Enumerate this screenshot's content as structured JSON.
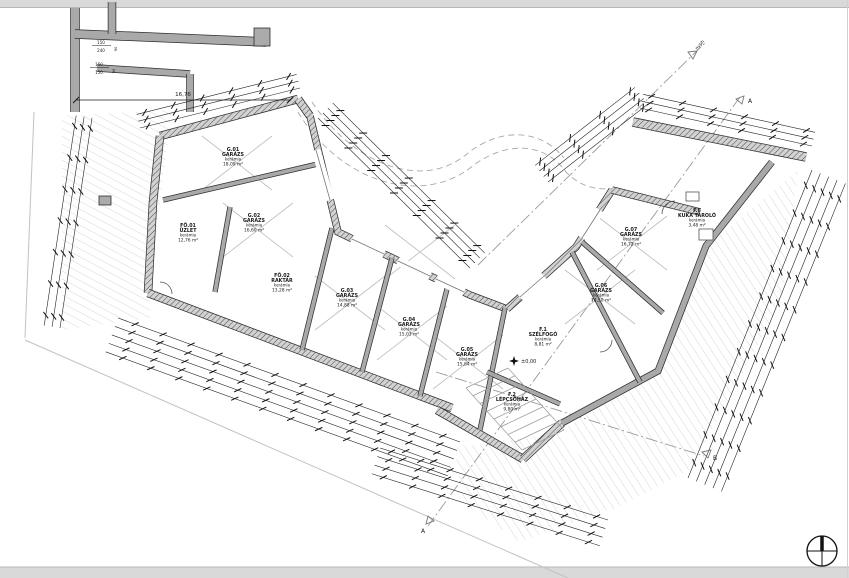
{
  "drawing_title": "garázsszint alaprajz",
  "colors": {
    "wall_dark": "#2e2e2e",
    "wall_gray": "#a9a9a9",
    "wall_hatch_base": "#d2d2d2",
    "ground_hatch": "#cccccc",
    "dim_line": "#1a1a1a",
    "dashdot": "#9a9a9a",
    "text": "#1a1a1a",
    "page_band": "#d9d9d9"
  },
  "rooms": [
    {
      "id": "G.01",
      "name": "GARÁZS",
      "finish": "kerámia",
      "area": "18,09 m²",
      "x": 233,
      "y": 158
    },
    {
      "id": "G.02",
      "name": "GARÁZS",
      "finish": "kerámia",
      "area": "16,60 m²",
      "x": 254,
      "y": 224
    },
    {
      "id": "FÖ.01",
      "name": "ÜZLET",
      "finish": "kerámia",
      "area": "12,76 m²",
      "x": 188,
      "y": 234
    },
    {
      "id": "FÖ.02",
      "name": "RAKTÁR",
      "finish": "kerámia",
      "area": "13,28 m²",
      "x": 282,
      "y": 284
    },
    {
      "id": "G.03",
      "name": "GARÁZS",
      "finish": "kerámia",
      "area": "14,88 m²",
      "x": 347,
      "y": 299
    },
    {
      "id": "G.04",
      "name": "GARÁZS",
      "finish": "kerámia",
      "area": "15,03 m²",
      "x": 409,
      "y": 328
    },
    {
      "id": "G.05",
      "name": "GARÁZS",
      "finish": "kerámia",
      "area": "15,84 m²",
      "x": 467,
      "y": 358
    },
    {
      "id": "F.1",
      "name": "SZÉLFOGÓ",
      "finish": "kerámia",
      "area": "8,81 m²",
      "x": 543,
      "y": 338
    },
    {
      "id": "F.2",
      "name": "LÉPCSŐHÁZ",
      "finish": "kerámia",
      "area": "9,80 m²",
      "x": 512,
      "y": 403
    },
    {
      "id": "G.06",
      "name": "GARÁZS",
      "finish": "kerámia",
      "area": "14,50 m²",
      "x": 601,
      "y": 294
    },
    {
      "id": "G.07",
      "name": "GARÁZS",
      "finish": "kerámia",
      "area": "16,72 m²",
      "x": 631,
      "y": 238
    },
    {
      "id": "F.6",
      "name": "KUKA TÁROLÓ",
      "finish": "kerámia",
      "area": "3,48 m²",
      "x": 697,
      "y": 219
    }
  ],
  "annotations": {
    "level_mark": "±0,00",
    "dim_total": "16,76",
    "window_1_top": "150",
    "window_1_bottom": "240",
    "window_2_top": "150",
    "window_2_bottom": "150",
    "sill_1": "90",
    "sill_2": "90",
    "section_a": "A",
    "section_b": "B",
    "boundary_label": "nyph"
  }
}
